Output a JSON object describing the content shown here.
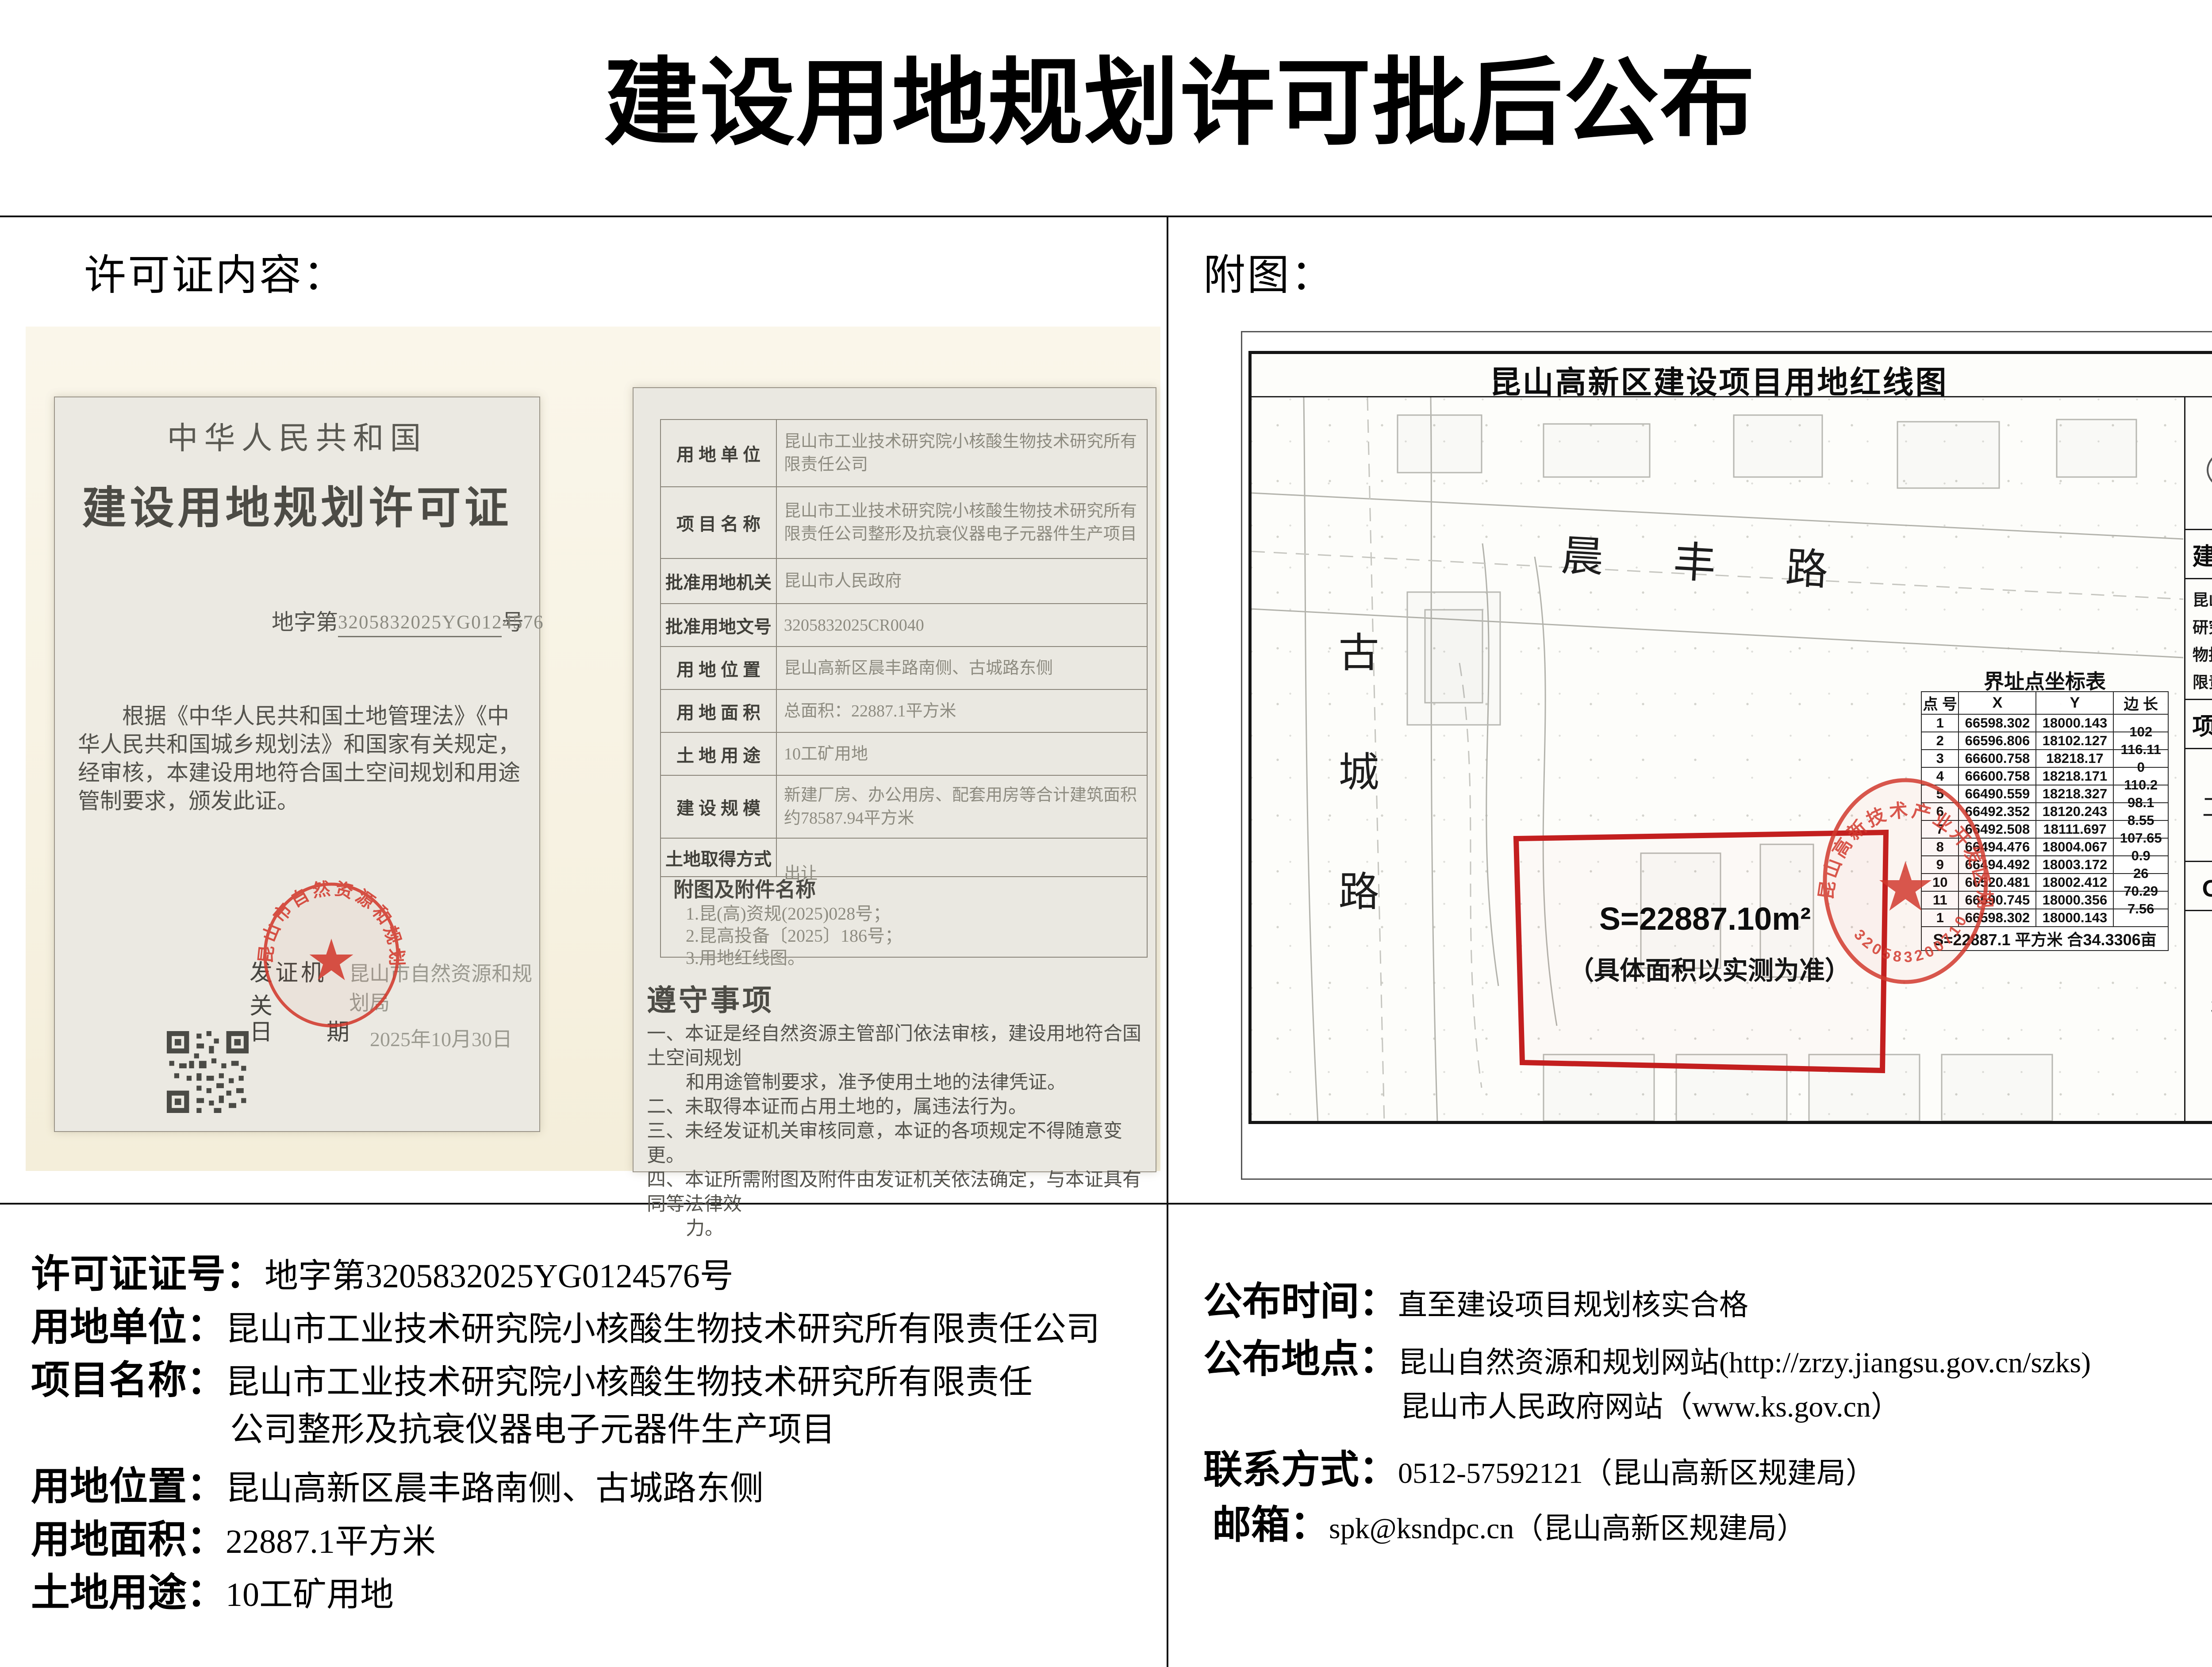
{
  "page_title": "建设用地规划许可批后公布",
  "colors": {
    "map_red": "#c31f1f",
    "seal_red": "#d23a2e",
    "photo_bg": "#f8f3e4"
  },
  "left": {
    "section_title": "许可证内容：",
    "permit": {
      "country": "中华人民共和国",
      "cert_title": "建设用地规划许可证",
      "number_prefix": "地字第",
      "number": "3205832025YG0124576",
      "number_suffix": "号",
      "body_lines": [
        "根据《中华人民共和国土地管理法》《中",
        "华人民共和国城乡规划法》和国家有关规定，",
        "经审核，本建设用地符合国土空间规划和用途",
        "管制要求，颁发此证。"
      ],
      "issuer_label": "发证机关",
      "issuer": "昆山市自然资源和规划局",
      "date_label": "日　　期",
      "date": "2025年10月30日",
      "seal_text": "昆山市自然资源和规划局"
    },
    "form": {
      "rows": [
        {
          "label": "用 地 单 位",
          "value": "昆山市工业技术研究院小核酸生物技术研究所有限责任公司"
        },
        {
          "label": "项 目 名 称",
          "value": "昆山市工业技术研究院小核酸生物技术研究所有限责任公司整形及抗衰仪器电子元器件生产项目"
        },
        {
          "label": "批准用地机关",
          "value": "昆山市人民政府"
        },
        {
          "label": "批准用地文号",
          "value": "3205832025CR0040"
        },
        {
          "label": "用 地 位 置",
          "value": "昆山高新区晨丰路南侧、古城路东侧"
        },
        {
          "label": "用 地 面 积",
          "value": "总面积：22887.1平方米"
        },
        {
          "label": "土 地 用 途",
          "value": "10工矿用地"
        },
        {
          "label": "建 设 规 模",
          "value": "新建厂房、办公用房、配套用房等合计建筑面积约78587.94平方米"
        },
        {
          "label": "土地取得方式",
          "value": "出让"
        }
      ],
      "attachments_label": "附图及附件名称",
      "attachments": [
        "1.昆(高)资规(2025)028号；",
        "2.昆高投备〔2025〕186号；",
        "3.用地红线图。"
      ],
      "notes_title": "遵守事项",
      "notes_lines": [
        "一、本证是经自然资源主管部门依法审核，建设用地符合国土空间规划",
        "和用途管制要求，准予使用土地的法律凭证。",
        "二、未取得本证而占用土地的，属违法行为。",
        "三、未经发证机关审核同意，本证的各项规定不得随意变更。",
        "四、本证所需附图及附件由发证机关依法确定，与本证具有同等法律效",
        "力。"
      ]
    },
    "details": [
      {
        "label": "许可证证号：",
        "value": "地字第3205832025YG0124576号"
      },
      {
        "label": "用地单位：",
        "value": "昆山市工业技术研究院小核酸生物技术研究所有限责任公司"
      },
      {
        "label": "项目名称：",
        "value": "昆山市工业技术研究院小核酸生物技术研究所有限责任"
      },
      {
        "label": "",
        "value": "公司整形及抗衰仪器电子元器件生产项目"
      },
      {
        "label": "用地位置：",
        "value": "昆山高新区晨丰路南侧、古城路东侧"
      },
      {
        "label": "用地面积：",
        "value": "22887.1平方米"
      },
      {
        "label": "土地用途：",
        "value": "10工矿用地"
      }
    ]
  },
  "right": {
    "section_title": "附图：",
    "map": {
      "title": "昆山高新区建设项目用地红线图",
      "road_horizontal": "晨丰路",
      "road_vertical": "古城路",
      "area_label": "S=22887.10m²",
      "area_note": "（具体面积以实测为准）",
      "coord_table": {
        "title": "界址点坐标表",
        "headers": [
          "点 号",
          "X",
          "Y",
          "边 长"
        ],
        "rows": [
          {
            "n": "1",
            "x": "66598.302",
            "y": "18000.143",
            "l": "102"
          },
          {
            "n": "2",
            "x": "66596.806",
            "y": "18102.127",
            "l": "116.11"
          },
          {
            "n": "3",
            "x": "66600.758",
            "y": "18218.17",
            "l": "0"
          },
          {
            "n": "4",
            "x": "66600.758",
            "y": "18218.171",
            "l": "110.2"
          },
          {
            "n": "5",
            "x": "66490.559",
            "y": "18218.327",
            "l": "98.1"
          },
          {
            "n": "6",
            "x": "66492.352",
            "y": "18120.243",
            "l": "8.55"
          },
          {
            "n": "7",
            "x": "66492.508",
            "y": "18111.697",
            "l": "107.65"
          },
          {
            "n": "8",
            "x": "66494.476",
            "y": "18004.067",
            "l": "0.9"
          },
          {
            "n": "9",
            "x": "66494.492",
            "y": "18003.172",
            "l": "26"
          },
          {
            "n": "10",
            "x": "66520.481",
            "y": "18002.412",
            "l": "70.29"
          },
          {
            "n": "11",
            "x": "66590.745",
            "y": "18000.356",
            "l": "7.56"
          },
          {
            "n": "1",
            "x": "66598.302",
            "y": "18000.143",
            "l": ""
          }
        ],
        "footer": "S=22887.1 平方米 合34.3306亩"
      },
      "compass_label": "N",
      "sidebar": {
        "owner_header": "建 设 单 位",
        "owner": "昆山市工业技术研究院小核酸生物技术研究所有限责任公司",
        "project_header": "项 目 名 称",
        "project": "工业产房",
        "oa_header": "OA 编 号",
        "oa_number": "391151"
      },
      "seal_text": "昆山高新技术产业开发区规划建设局",
      "seal_number": "3205832007102"
    },
    "details": [
      {
        "label": "公布时间：",
        "value": "直至建设项目规划核实合格"
      },
      {
        "label": "公布地点：",
        "value": "昆山自然资源和规划网站(http://zrzy.jiangsu.gov.cn/szks)"
      },
      {
        "label": "",
        "value": "昆山市人民政府网站（www.ks.gov.cn）"
      },
      {
        "label": "联系方式：",
        "value": "0512-57592121（昆山高新区规建局）"
      },
      {
        "label": "邮箱：",
        "value": "spk@ksndpc.cn（昆山高新区规建局）"
      }
    ]
  }
}
